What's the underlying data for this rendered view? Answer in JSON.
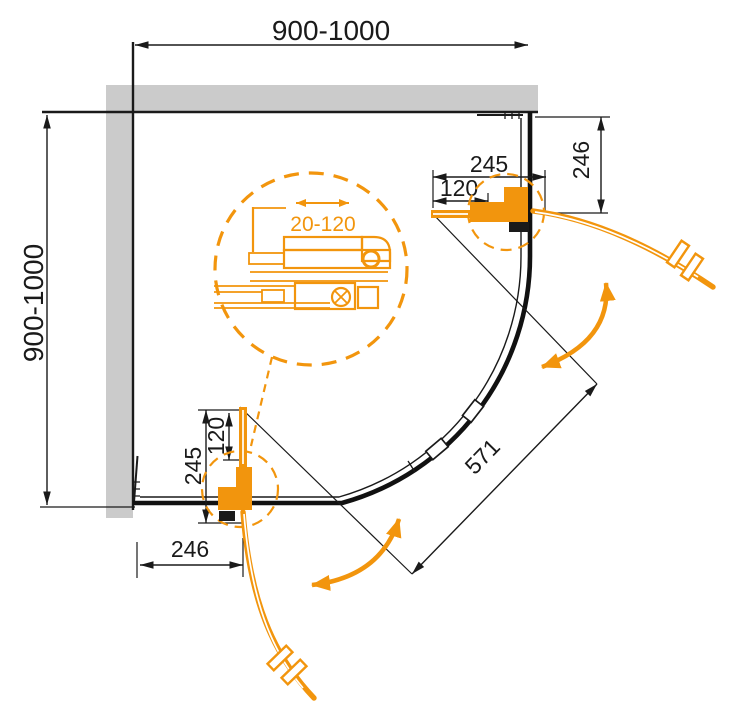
{
  "colors": {
    "accent_orange": "#F2950D",
    "wall_gray": "#CBCBCB",
    "line_black": "#1A1A1A",
    "background": "#FFFFFF"
  },
  "dims": {
    "overall_width": "900-1000",
    "overall_depth": "900-1000",
    "diagonal_opening": "571",
    "profile_adjust": "20-120"
  },
  "door_top": {
    "length": "245",
    "pivot": "120",
    "side": "246"
  },
  "door_bottom": {
    "length": "245",
    "pivot": "120",
    "side": "246"
  }
}
